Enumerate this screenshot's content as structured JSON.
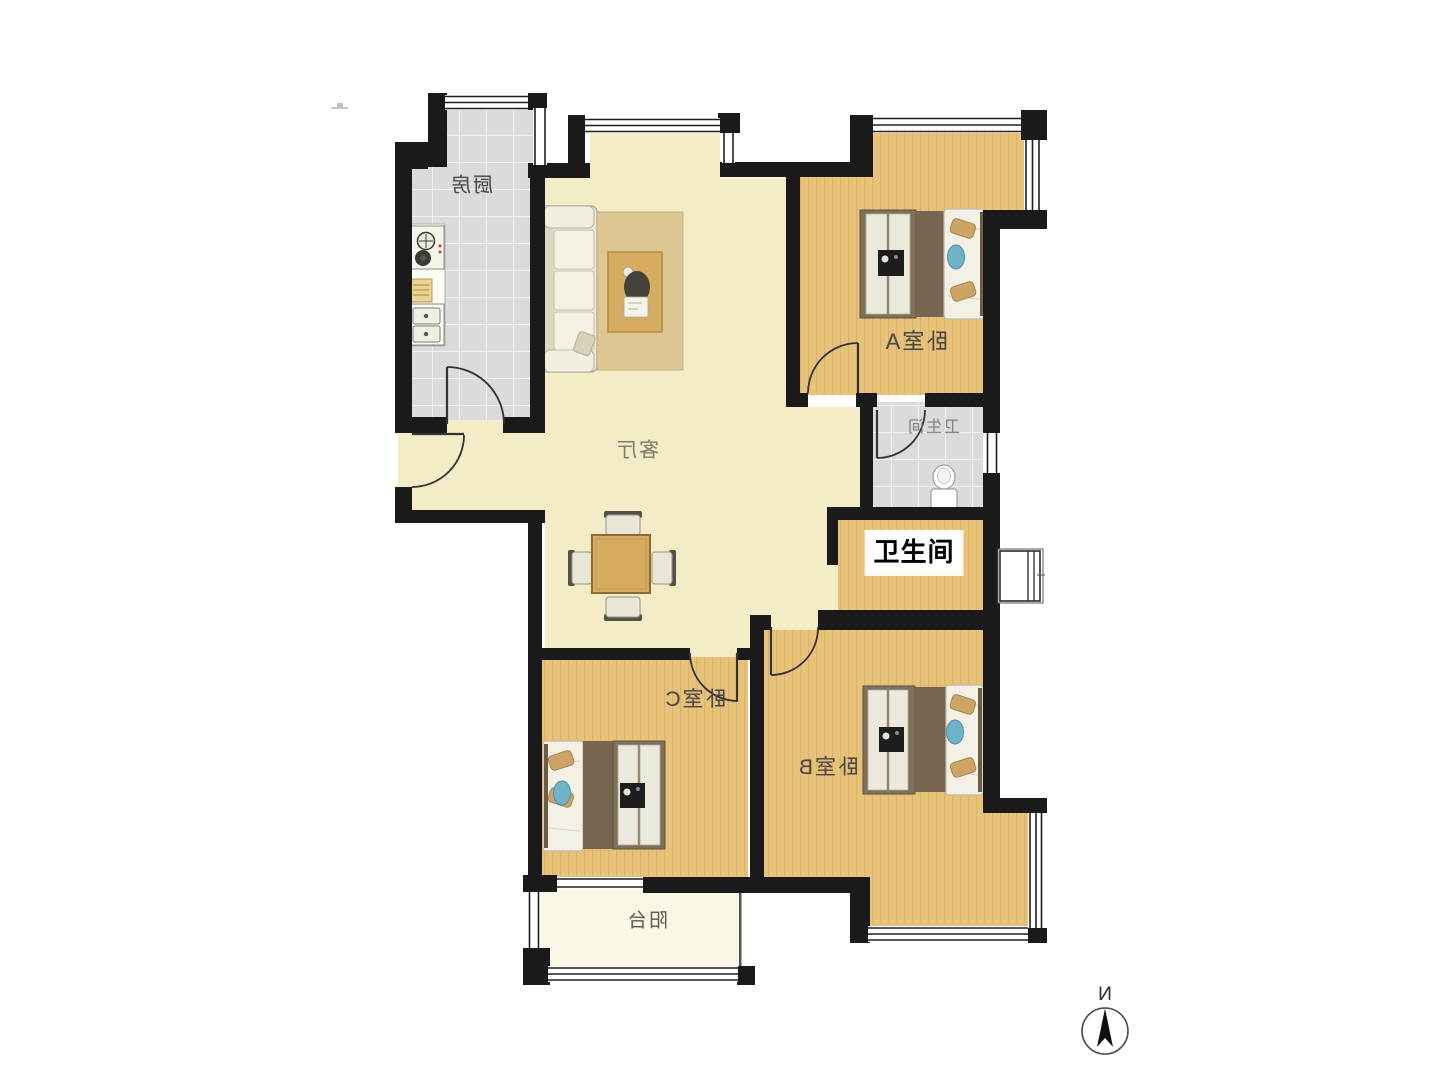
{
  "labels": {
    "kitchen": "厨房",
    "living_room": "客厅",
    "bedroom_a": "卧室A",
    "bathroom": "卫生间",
    "bathroom_annotation": "卫生间",
    "bedroom_b": "卧室B",
    "bedroom_c": "卧室C",
    "balcony": "阳台",
    "compass_north": "N"
  },
  "colors": {
    "wall": "#1a1a1a",
    "wood_floor": "#e9c27a",
    "wood_grain": "#b27a2e",
    "tile_floor": "#d9dcda",
    "tile_grout": "#f0f2f0",
    "cream_floor": "#f4ecc6",
    "balcony_floor": "#fbf7e7",
    "window_line": "#1f1f1f",
    "door_line": "#333333",
    "rug": "#dcc793",
    "table_wood": "#d6ad60",
    "mat_brown": "#77664f",
    "wardrobe_frame": "#7e7059",
    "pillow_tan": "#cda465",
    "pillow_blue": "#6fb3c8",
    "label_text": "#4a4a4a",
    "annotation_text": "#000000",
    "annotation_bg": "#ffffff"
  }
}
